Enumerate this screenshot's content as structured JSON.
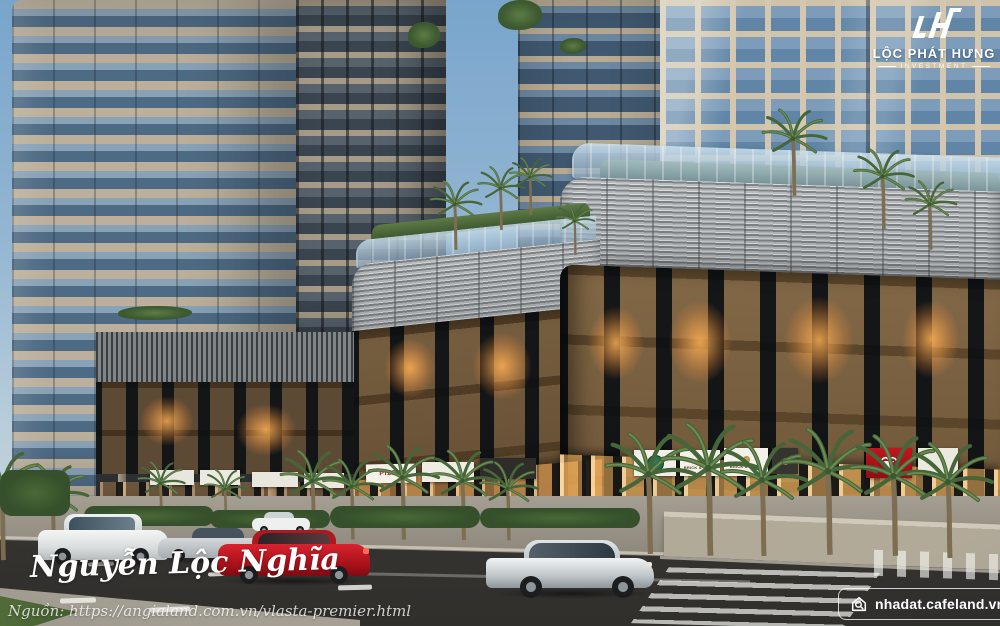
{
  "developer_logo": {
    "monogram": "LH",
    "name": "LỘC PHÁT HƯNG",
    "subtitle": "INVESTMENT"
  },
  "watermarks": {
    "author_signature": "Nguyễn Lộc Nghĩa",
    "source_line": "Nguồn: https://angialand.com.vn/vlasta-premier.html",
    "site_badge": "nhadat.cafeland.vn"
  },
  "storefronts": {
    "pizza_sign": "PIZZA",
    "brick_grill_sign_1": "BRICK & GRILL",
    "brick_grill_sign_2": "BRICK & GRILL"
  },
  "palette": {
    "sky_top": "#79a5cc",
    "sky_bottom": "#cdd8de",
    "tower_beige": "#bcb09c",
    "tower_glass": "#4e6b85",
    "right_tower_mullion": "#d3c7af",
    "right_tower_glass": "#7c9cba",
    "podium_dark": "#2c2a28",
    "podium_screen": "#b4b6b7",
    "window_glow": "#f5a94e",
    "asphalt": "#3c3b38",
    "sidewalk": "#98938a",
    "foliage": "#4a6838",
    "car_red": "#c3161f",
    "car_silver": "#c7c9cb",
    "car_white": "#eef0f1"
  }
}
